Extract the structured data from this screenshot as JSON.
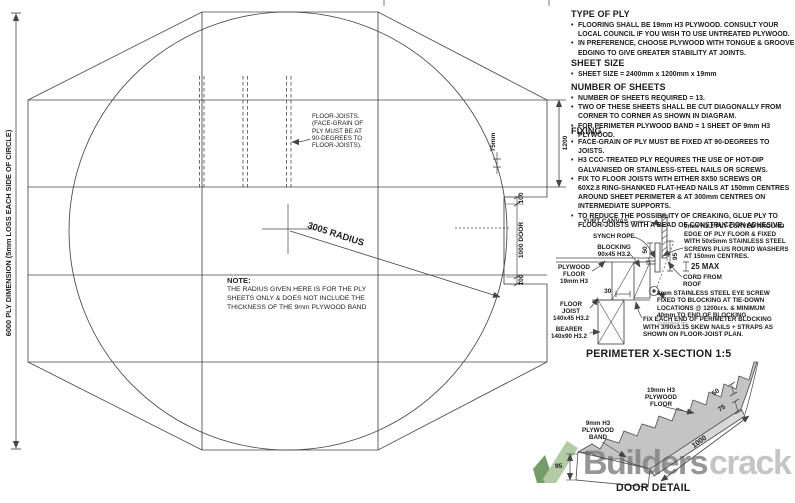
{
  "specs": {
    "type_of_ply": {
      "title": "TYPE OF PLY",
      "bullets": [
        "FLOORING SHALL BE 19mm H3 PLYWOOD. CONSULT YOUR\nLOCAL COUNCIL IF YOU WISH TO USE UNTREATED PLYWOOD.",
        "IN PREFERENCE, CHOOSE PLYWOOD WITH TONGUE & GROOVE\nEDGING TO GIVE GREATER STABILITY AT JOINTS."
      ]
    },
    "sheet_size": {
      "title": "SHEET SIZE",
      "bullets": [
        "SHEET SIZE = 2400mm x 1200mm x 19mm"
      ]
    },
    "number_of_sheets": {
      "title": "NUMBER OF SHEETS",
      "bullets": [
        "NUMBER OF SHEETS REQUIRED = 13.",
        "TWO OF THESE SHEETS SHALL BE CUT DIAGONALLY FROM\nCORNER TO CORNER AS SHOWN IN DIAGRAM.",
        "FOR PERIMETER PLYWOOD BAND = 1 SHEET OF 9mm H3 PLYWOOD."
      ]
    },
    "fixing": {
      "title": "FIXING",
      "bullets": [
        "FACE-GRAIN OF PLY MUST BE FIXED AT 90-DEGREES TO JOISTS.",
        "H3 CCC-TREATED PLY REQUIRES THE USE OF HOT-DIP\nGALVANISED OR STAINLESS-STEEL NAILS OR SCREWS.",
        "FIX TO FLOOR JOISTS WITH EITHER 8X50 SCREWS OR\n60X2.8 RING-SHANKED FLAT-HEAD NAILS AT 150mm CENTRES\nAROUND SHEET PERIMETER & AT 300mm CENTRES ON\nINTERMEDIATE SUPPORTS.",
        "TO REDUCE THE POSSIBILITY OF CREAKING, GLUE PLY TO\nFLOOR-JOISTS WITH A BEAD OF CONSTRUCTION ADHESIVE."
      ]
    }
  },
  "plan": {
    "left_dim_label": "6000 PLY DIMENSION (5mm LOSS EACH SIDE OF CIRCLE)",
    "joists_label": "FLOOR-JOISTS.\n(FACE-GRAIN OF\nPLY MUST BE AT\n90-DEGREES TO\nFLOOR-JOISTS).",
    "radius_label": "3005 RADIUS",
    "dim_75": "75mm",
    "dim_1200": "1200",
    "dim_door_top": "100",
    "dim_door": "1000 DOOR",
    "dim_door_bottom": "100",
    "note_title": "NOTE:",
    "note_body": "THE RADIUS GIVEN HERE IS FOR THE PLY\nSHEETS ONLY & DOES NOT INCLUDE THE\nTHICKNESS OF THE 9mm PLYWOOD BAND"
  },
  "xsection": {
    "title": "PERIMETER X-SECTION 1:5",
    "yurt_canvas": "YURT CANVAS",
    "synch_rope": "SYNCH ROPE",
    "blocking": "BLOCKING\n90x45 H3.2",
    "plywood_floor": "PLYWOOD\nFLOOR\n19mm H3",
    "floor_joist": "FLOOR\nJOIST\n140x45 H3.2",
    "bearer": "BEARER\n140x90 H3.2",
    "dim_30": "30",
    "dim_50": "50",
    "dim_95": "95",
    "dim_25": "25 MAX",
    "band_note": "9mm H3.2 PLY CURVED AROUND\nEDGE OF PLY FLOOR & FIXED\nWITH 50x5mm STAINLESS STEEL\nSCREWS PLUS ROUND WASHERS\nAT 150mm CENTRES.",
    "cord": "CORD FROM\nROOF",
    "eye_screw_note": "8mm STAINLESS STEEL EYE SCREW\nFIXED TO BLOCKING AT TIE-DOWN\nLOCATIONS @ 1200crs. & MINIMUM\n40mm TO END OF BLOCKING.",
    "supplied_by": "Supplied by.",
    "fix_note": "FIX EACH END OF PERIMETER BLOCKING\nWITH 3/90x3.15 SKEW NAILS + STRAPS AS\nSHOWN ON FLOOR-JOIST PLAN."
  },
  "door_detail": {
    "title": "DOOR DETAIL",
    "floor_label": "19mm H3\nPLYWOOD\nFLOOR",
    "band_label": "9mm H3\nPLYWOOD\nBAND",
    "dim_50": "50",
    "dim_75": "75",
    "dim_1000": "1000",
    "dim_95": "95"
  },
  "watermark": {
    "bold": "Builders",
    "light": "crack"
  },
  "colors": {
    "line": "#454545",
    "watermark_dark": "#848484",
    "watermark_light": "#bcbcbc",
    "logo_green_dark": "#5e8c4e",
    "logo_green_light": "#a6c296"
  }
}
